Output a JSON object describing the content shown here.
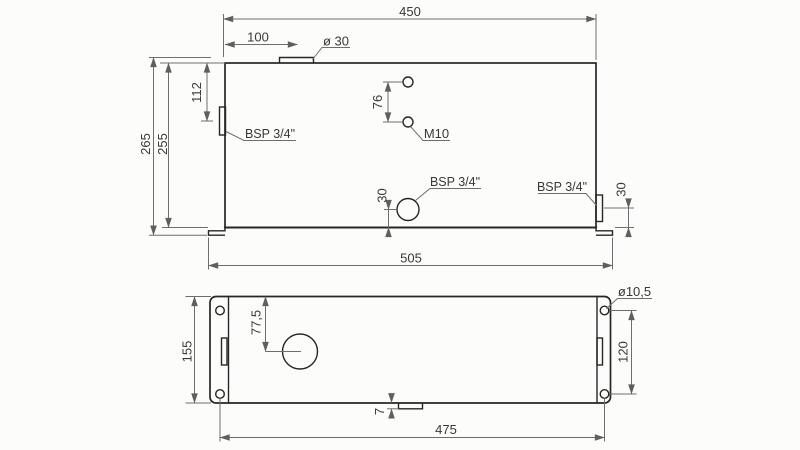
{
  "drawing": {
    "type": "technical-drawing-two-view-tank",
    "colors": {
      "outline": "#262626",
      "dimension_lines": "#6e6e6e",
      "text": "#383838",
      "background": "#fcfcfb"
    },
    "front": {
      "dim_width_top": "450",
      "dim_neck_offset": "100",
      "label_neck_dia": "ø 30",
      "dim_port_height": "112",
      "dim_overall_height": "265",
      "dim_body_height": "255",
      "dim_hole_spacing": "76",
      "label_m10": "M10",
      "label_bsp_left": "BSP 3/4\"",
      "label_bsp_front": "BSP 3/4\"",
      "label_bsp_right": "BSP 3/4\"",
      "dim_front_port_from_bottom": "30",
      "dim_right_port_from_bottom": "30",
      "dim_base_width": "505"
    },
    "plan": {
      "dim_depth": "155",
      "dim_circle_from_edge": "77,5",
      "label_hole_dia": "ø10,5",
      "dim_holes_vertical": "120",
      "dim_holes_horizontal": "475",
      "dim_tab": "7"
    }
  }
}
